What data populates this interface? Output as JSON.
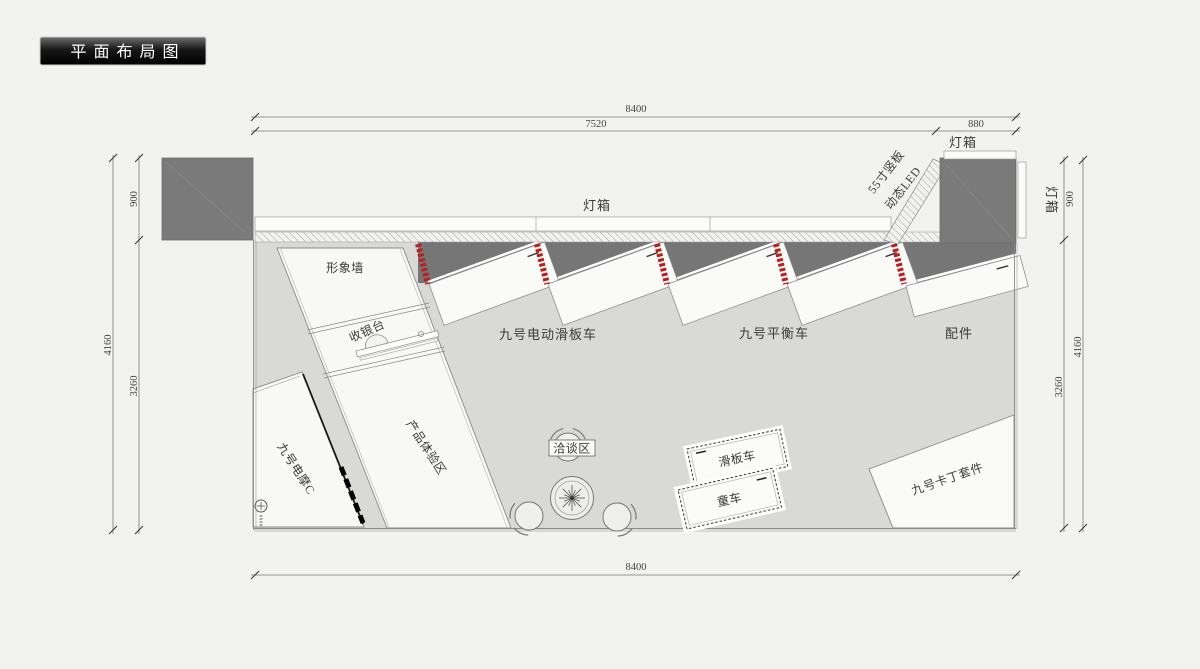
{
  "title": "平面布局图",
  "dims": {
    "top_total": "8400",
    "top_main": "7520",
    "top_right": "880",
    "bottom_total": "8400",
    "left_total": "4160",
    "left_top": "900",
    "left_bottom": "3260",
    "right_total": "4160",
    "right_top": "900",
    "right_bottom": "3260"
  },
  "labels": {
    "lightbox_top": "灯箱",
    "lightbox_corner": "灯箱",
    "lightbox_side": "灯箱",
    "led_line1": "55寸竖板",
    "led_line2": "动态LED",
    "image_wall": "形象墙",
    "cashier": "收银台",
    "experience_zone": "产品体验区",
    "emoto": "九号电摩C",
    "escooter_zone": "九号电动滑板车",
    "balance_zone": "九号平衡车",
    "accessories_zone": "配件",
    "meeting_zone": "洽谈区",
    "scooter_table": "滑板车",
    "kids_table": "童车",
    "kart_zone": "九号卡丁套件"
  },
  "colors": {
    "background": "#f2f2f1",
    "floor": "#d9d9d8",
    "white_area": "#f8f8f7",
    "wall_dark": "#7a7a7a",
    "accent_red": "#b81f1f",
    "line": "#777777"
  }
}
